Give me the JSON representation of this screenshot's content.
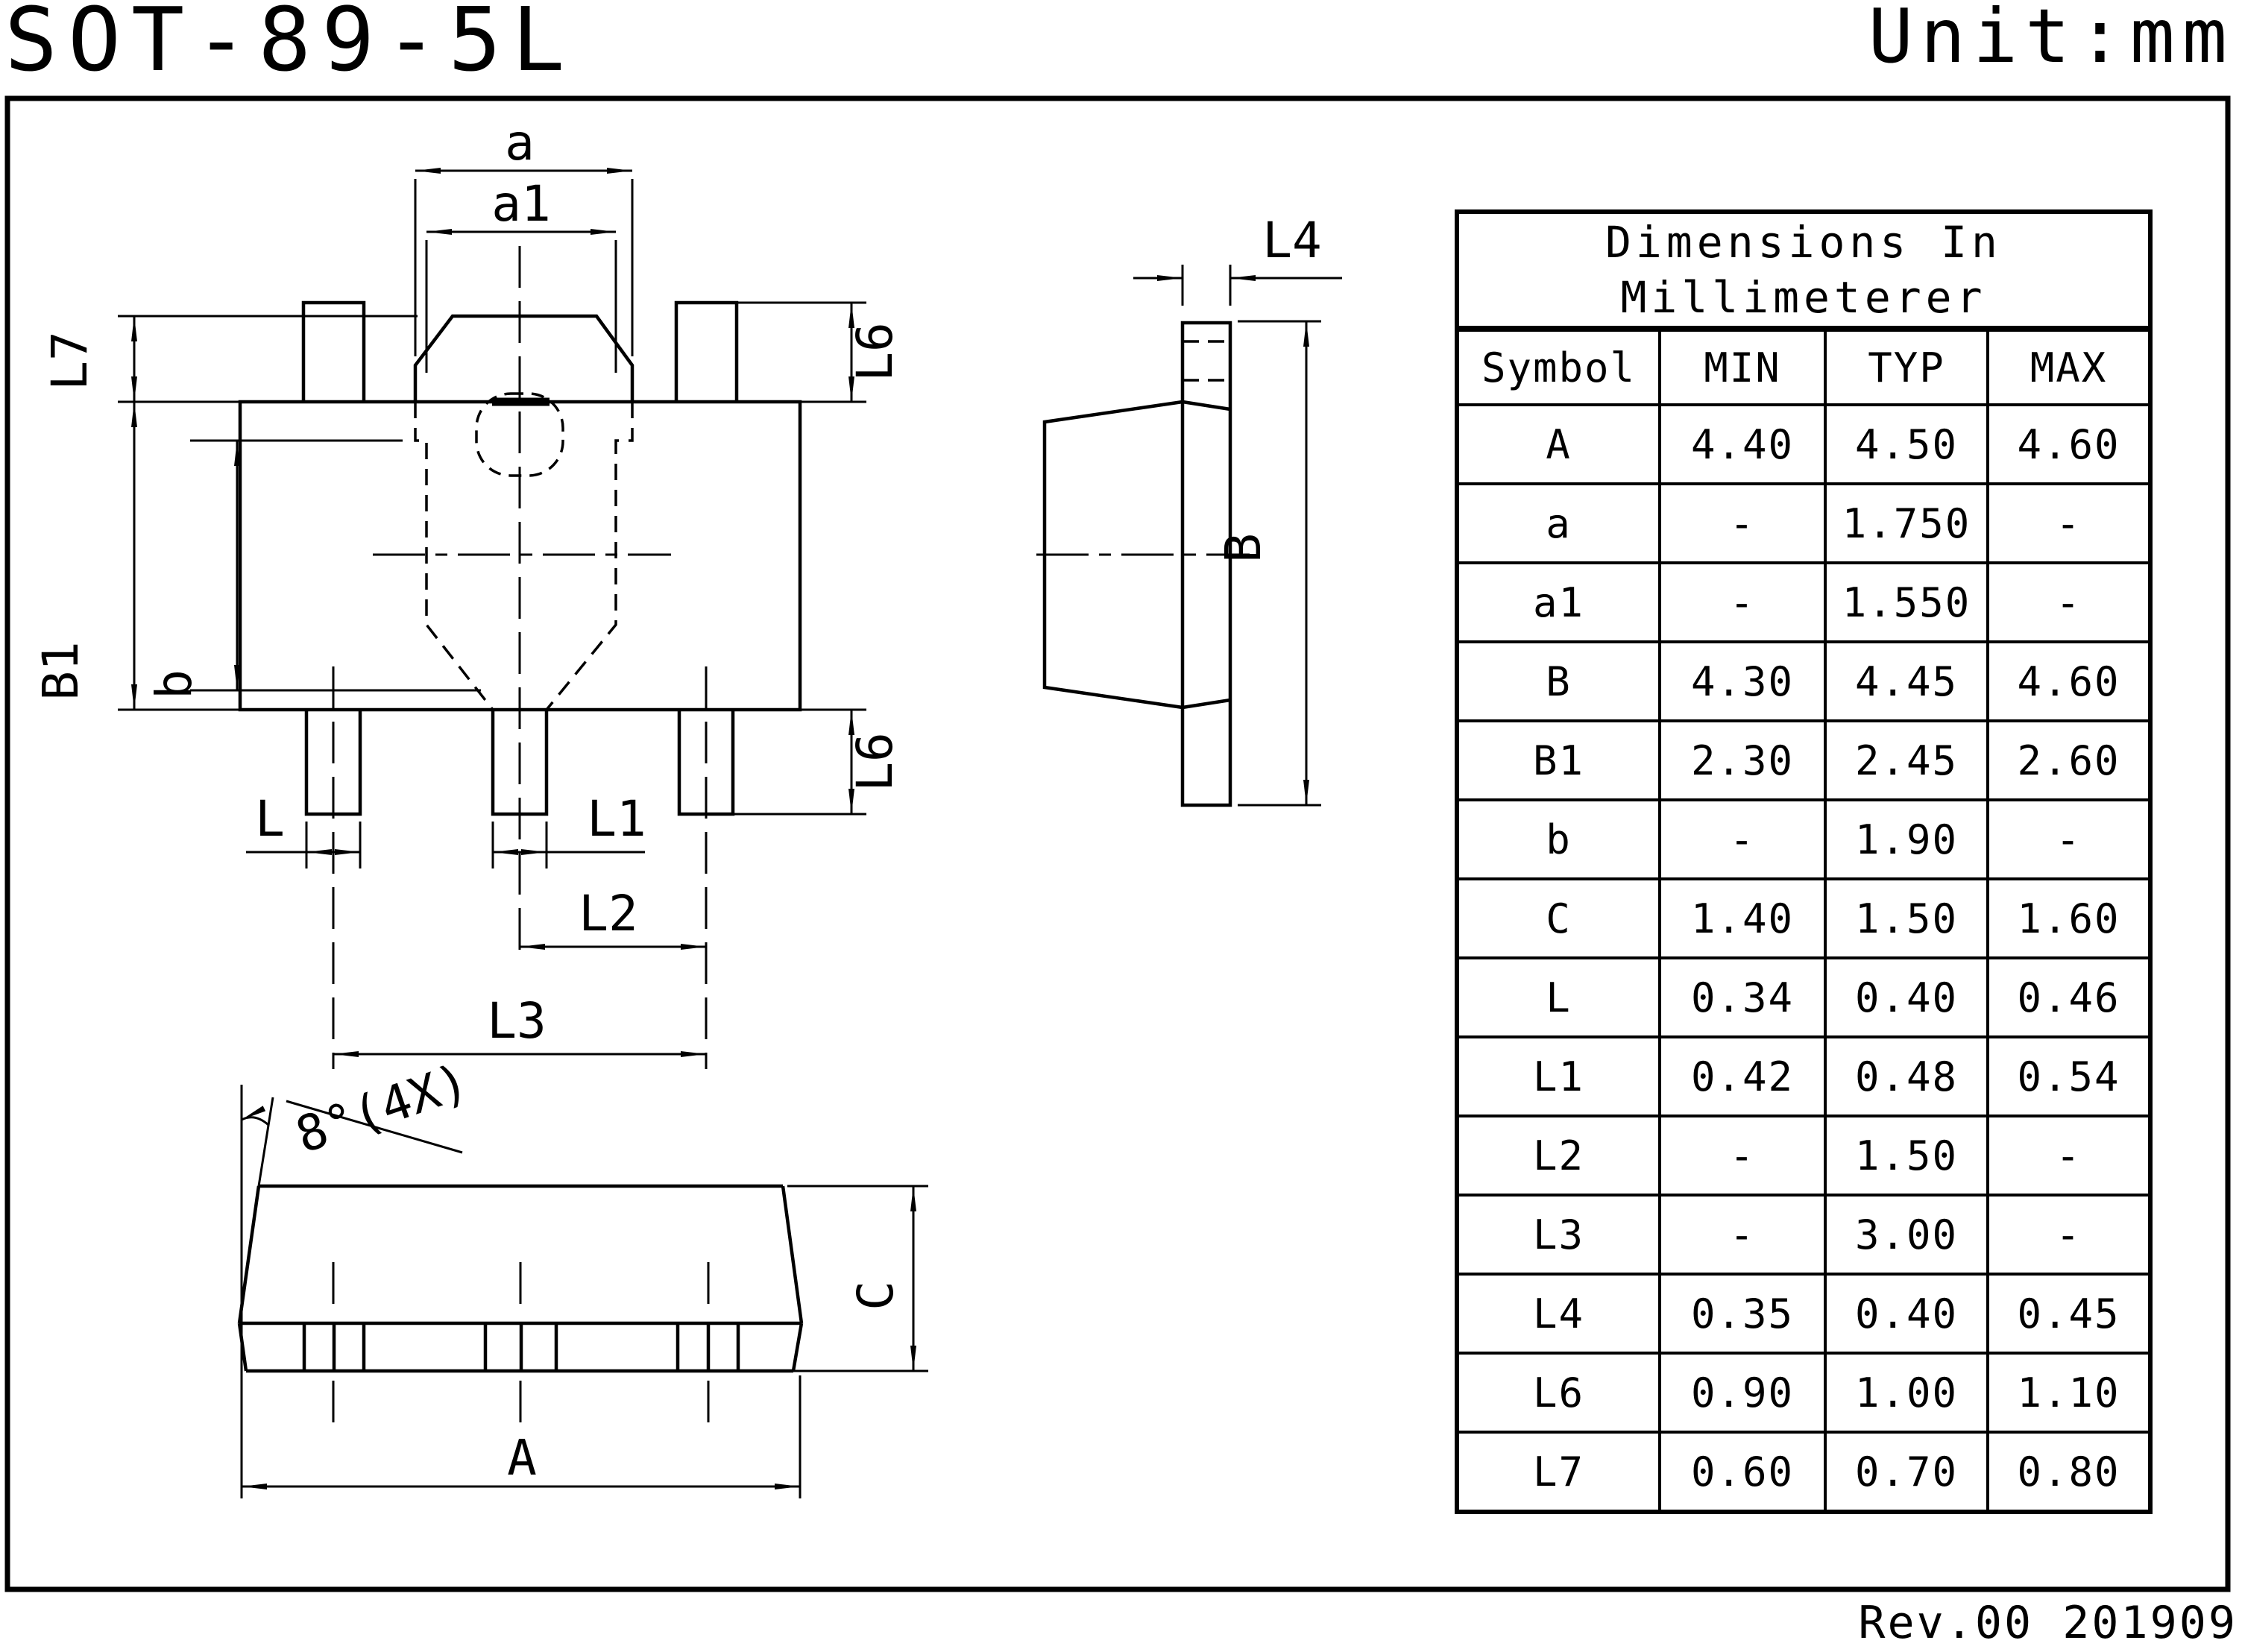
{
  "header": {
    "title": "SOT-89-5L",
    "unit": "Unit:mm"
  },
  "footer": {
    "revision": "Rev.00 201909"
  },
  "table": {
    "title": "Dimensions  In\nMillimeterer",
    "headers": [
      "Symbol",
      "MIN",
      "TYP",
      "MAX"
    ],
    "rows": [
      {
        "symbol": "A",
        "min": "4.40",
        "typ": "4.50",
        "max": "4.60"
      },
      {
        "symbol": "a",
        "min": "-",
        "typ": "1.750",
        "max": "-"
      },
      {
        "symbol": "a1",
        "min": "-",
        "typ": "1.550",
        "max": "-"
      },
      {
        "symbol": "B",
        "min": "4.30",
        "typ": "4.45",
        "max": "4.60"
      },
      {
        "symbol": "B1",
        "min": "2.30",
        "typ": "2.45",
        "max": "2.60"
      },
      {
        "symbol": "b",
        "min": "-",
        "typ": "1.90",
        "max": "-"
      },
      {
        "symbol": "C",
        "min": "1.40",
        "typ": "1.50",
        "max": "1.60"
      },
      {
        "symbol": "L",
        "min": "0.34",
        "typ": "0.40",
        "max": "0.46"
      },
      {
        "symbol": "L1",
        "min": "0.42",
        "typ": "0.48",
        "max": "0.54"
      },
      {
        "symbol": "L2",
        "min": "-",
        "typ": "1.50",
        "max": "-"
      },
      {
        "symbol": "L3",
        "min": "-",
        "typ": "3.00",
        "max": "-"
      },
      {
        "symbol": "L4",
        "min": "0.35",
        "typ": "0.40",
        "max": "0.45"
      },
      {
        "symbol": "L6",
        "min": "0.90",
        "typ": "1.00",
        "max": "1.10"
      },
      {
        "symbol": "L7",
        "min": "0.60",
        "typ": "0.70",
        "max": "0.80"
      }
    ]
  },
  "drawing": {
    "labels": {
      "a": "a",
      "a1": "a1",
      "L7": "L7",
      "B1": "B1",
      "b": "b",
      "L6": "L6",
      "L": "L",
      "L1": "L1",
      "L2": "L2",
      "L3": "L3",
      "L4": "L4",
      "B": "B",
      "C": "C",
      "A": "A",
      "angle": "8°(4X)"
    }
  }
}
